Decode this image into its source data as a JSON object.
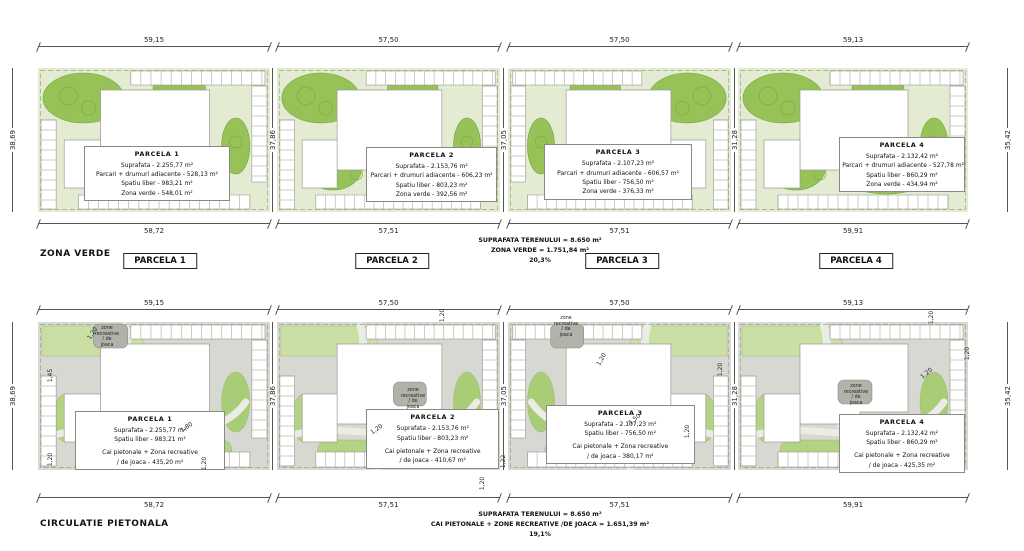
{
  "colors": {
    "green_bg": "#e3ecd2",
    "green_mid": "#92c050",
    "green_outline": "#74a339",
    "gray_paving": "#d8d8d3",
    "green_patch": "#b3d284",
    "recreative_gray": "#b2b2aa",
    "stall_line": "#9a9a94",
    "dim_line": "#555555"
  },
  "sections": [
    {
      "id": "zona-verde",
      "title": "ZONA VERDE",
      "summary_lines": [
        "SUPRAFATA TERENULUI = 8.650 m²",
        "ZONA VERDE = 1.751,84 m²",
        "20,3%"
      ],
      "top_dims": [
        "59,15",
        "57,50",
        "57,50",
        "59,13"
      ],
      "bottom_dims": [
        "58,72",
        "57,51",
        "57,51",
        "59,91"
      ],
      "left_dim": "38,69",
      "right_dim": "35,42",
      "inner_dims": [
        "37,86",
        "37,05",
        "31,28"
      ],
      "parcel_tags": [
        "PARCELA 1",
        "PARCELA 2",
        "PARCELA 3",
        "PARCELA 4"
      ],
      "parcels": [
        {
          "title": "PARCELA 1",
          "lines": [
            "Suprafata - 2.255,77 m²",
            "Parcari + drumuri adiacente - 528,13 m²",
            "Spatiu liber - 983,21 m²",
            "Zona verde - 548,01 m²"
          ]
        },
        {
          "title": "PARCELA 2",
          "lines": [
            "Suprafata - 2.153,76 m²",
            "Parcari + drumuri adiacente - 606,23 m²",
            "Spatiu liber - 803,23 m²",
            "Zona verde - 392,56 m²"
          ]
        },
        {
          "title": "PARCELA 3",
          "lines": [
            "Suprafata - 2.107,23 m²",
            "Parcari + drumuri adiacente - 606,57 m²",
            "Spatiu liber - 756,50 m²",
            "Zona verde - 376,33 m²"
          ]
        },
        {
          "title": "PARCELA 4",
          "lines": [
            "Suprafata - 2.132,42 m²",
            "Parcari + drumuri adiacente - 527,78 m²",
            "Spatiu liber - 860,29 m²",
            "Zona verde - 434,94 m²"
          ]
        }
      ]
    },
    {
      "id": "circulatie-pietonala",
      "title": "CIRCULATIE PIETONALA",
      "summary_lines": [
        "SUPRAFATA TERENULUI = 8.650 m²",
        "CAI PIETONALE + ZONE RECREATIVE /DE JOACA = 1.651,39 m²",
        "19,1%"
      ],
      "top_dims": [
        "59,15",
        "57,50",
        "57,50",
        "59,13"
      ],
      "bottom_dims": [
        "58,72",
        "57,51",
        "57,51",
        "59,91"
      ],
      "left_dim": "38,69",
      "right_dim": "35,42",
      "inner_dims": [
        "37,86",
        "37,05",
        "31,28"
      ],
      "zone_label": "zone\nrecreative\n/ de\njoaca",
      "small_dims": [
        "1,20",
        "1,45",
        "1,80",
        "1,20",
        "1,20",
        "1,20",
        "1,20",
        "1,22",
        "1,20",
        "1,20",
        "1,50",
        "1,20",
        "1,20",
        "1,20",
        "1,20",
        "1,20"
      ],
      "parcels": [
        {
          "title": "PARCELA 1",
          "lines": [
            "Suprafata - 2.255,77 m²",
            "Spatiu liber - 983,21 m²",
            "Cai pietonale + Zona recreative",
            "/ de joaca - 435,20 m²"
          ]
        },
        {
          "title": "PARCELA 2",
          "lines": [
            "Suprafata - 2.153,76 m²",
            "Spatiu liber - 803,23 m²",
            "Cai pietonale + Zona recreative",
            "/ de joaca - 410,67 m²"
          ]
        },
        {
          "title": "PARCELA 3",
          "lines": [
            "Suprafata - 2.107,23 m²",
            "Spatiu liber - 756,50 m²",
            "Cai pietonale + Zona recreative",
            "/ de joaca - 380,17 m²"
          ]
        },
        {
          "title": "PARCELA 4",
          "lines": [
            "Suprafata - 2.132,42 m²",
            "Spatiu liber - 860,29 m²",
            "Cai pietonale + Zona recreative",
            "/ de joaca - 425,35 m²"
          ]
        }
      ]
    }
  ]
}
